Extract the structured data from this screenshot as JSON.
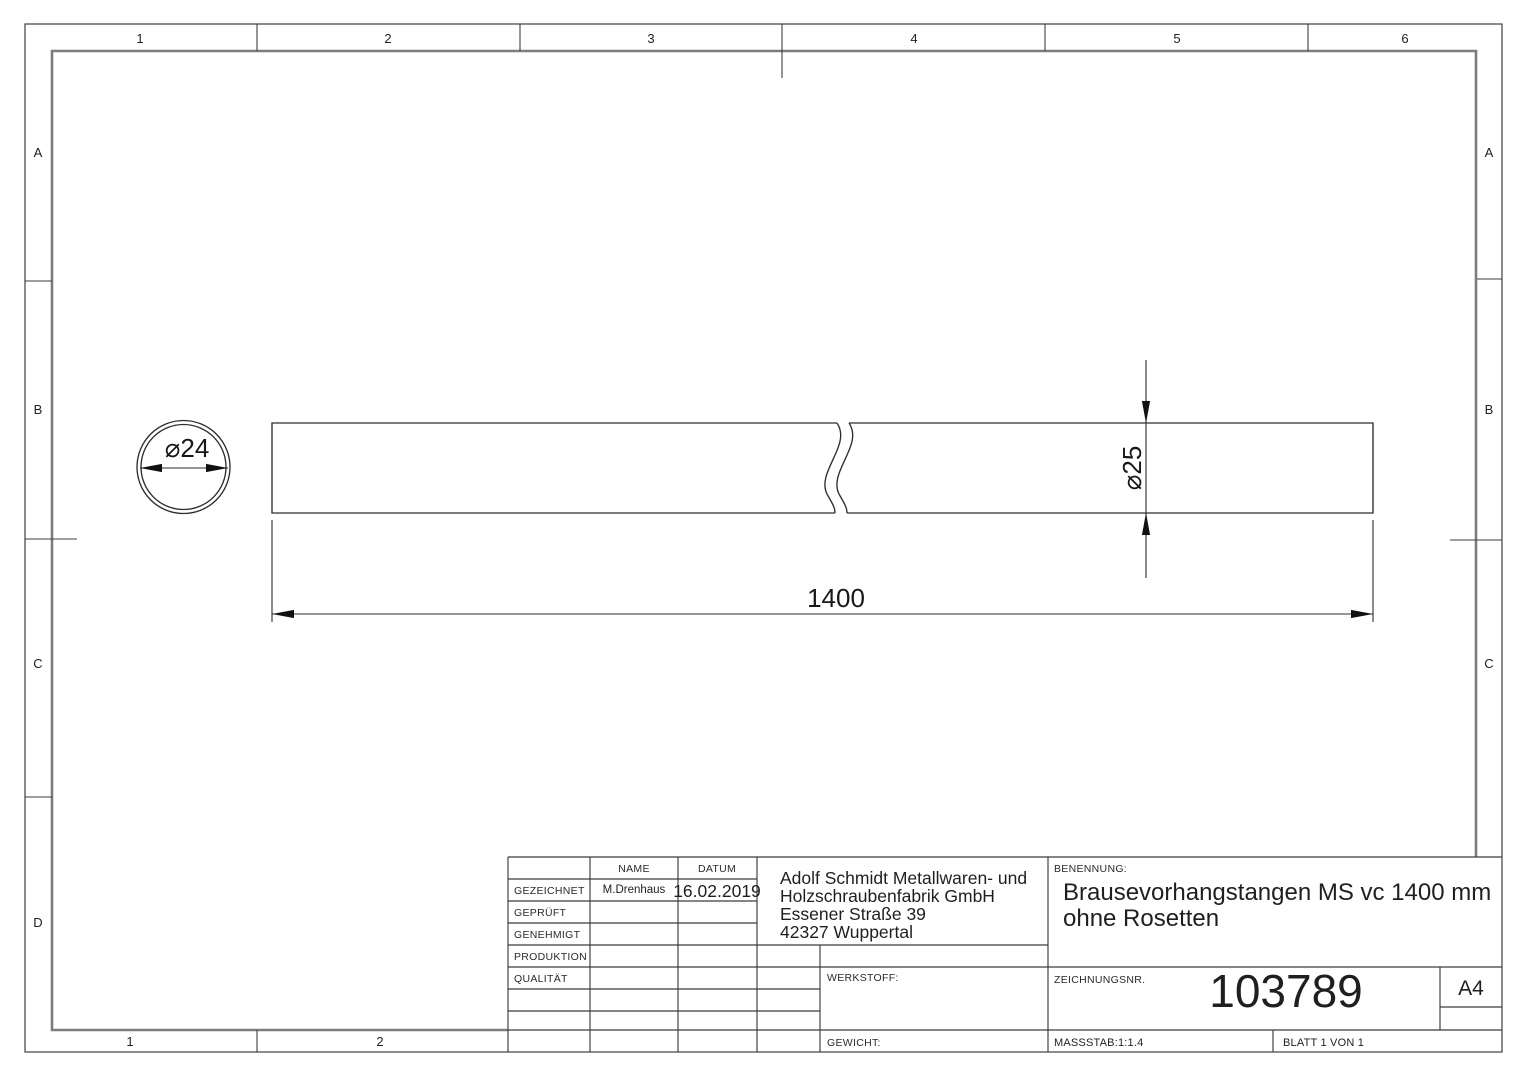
{
  "sheet": {
    "zone_columns": [
      "1",
      "2",
      "3",
      "4",
      "5",
      "6"
    ],
    "zone_rows": [
      "A",
      "B",
      "C",
      "D"
    ]
  },
  "drawing": {
    "end_view_diameter": "⌀24",
    "rod_diameter": "⌀25",
    "rod_length": "1400"
  },
  "title_block": {
    "name_header": "NAME",
    "datum_header": "DATUM",
    "rows": [
      {
        "label": "GEZEICHNET",
        "name": "M.Drenhaus",
        "datum": "16.02.2019"
      },
      {
        "label": "GEPRÜFT",
        "name": "",
        "datum": ""
      },
      {
        "label": "GENEHMIGT",
        "name": "",
        "datum": ""
      },
      {
        "label": "PRODUKTION",
        "name": "",
        "datum": ""
      },
      {
        "label": "QUALITÄT",
        "name": "",
        "datum": ""
      }
    ],
    "company_lines": [
      "Adolf Schmidt Metallwaren- und",
      "Holzschraubenfabrik GmbH",
      "Essener Straße 39",
      "42327 Wuppertal"
    ],
    "benennung_label": "BENENNUNG:",
    "benennung_lines": [
      "Brausevorhangstangen MS vc 1400 mm",
      "ohne Rosetten"
    ],
    "werkstoff_label": "WERKSTOFF:",
    "gewicht_label": "GEWICHT:",
    "zeichnungsnr_label": "ZEICHNUNGSNR.",
    "zeichnungsnr_value": "103789",
    "paper_format": "A4",
    "massstab": "MASSSTAB:1:1.4",
    "blatt": "BLATT 1 VON 1"
  },
  "colors": {
    "background": "#ffffff",
    "line": "#2e2e2e",
    "inner_frame": "#7d7d7d"
  }
}
